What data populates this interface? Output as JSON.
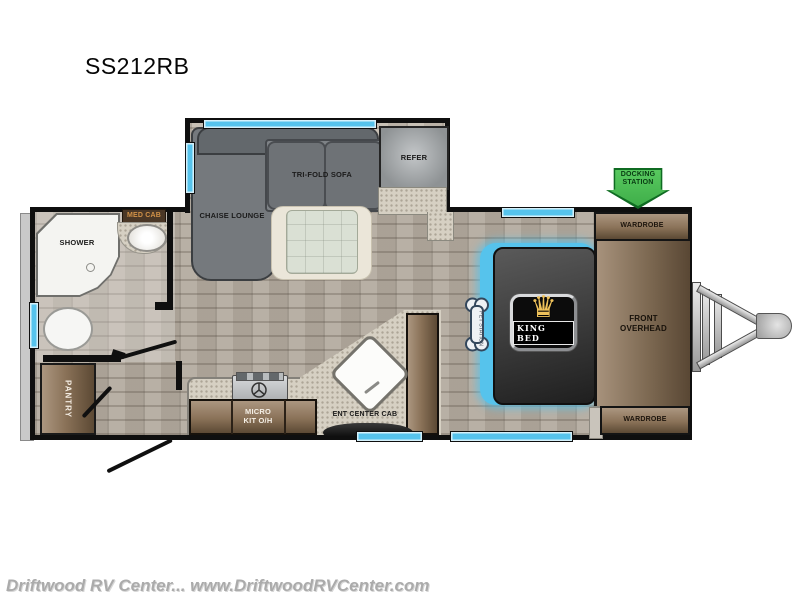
{
  "title": "SS212RB",
  "watermark": "Driftwood RV Center... www.DriftwoodRVCenter.com",
  "icons": {
    "crown": "♛"
  },
  "labels": {
    "shower": "SHOWER",
    "med_cab": "MED CAB",
    "chaise_lounge": "CHAISE LOUNGE",
    "tri_fold_sofa": "TRI-FOLD SOFA",
    "refer": "REFER",
    "docking_station": "DOCKING STATION",
    "wardrobe_front_top": "WARDROBE",
    "front_overhead": "FRONT OVERHEAD",
    "king_bed": "KING BED",
    "wardrobe_front_bottom": "WARDROBE",
    "pantry": "PANTRY",
    "micro_overhead": "MICRO KIT O/H",
    "ent_center_cab": "ENT CENTER CAB",
    "pet_station": "PET STATION"
  },
  "colors": {
    "window_blue": "#56c3ec",
    "docking_green": "#3fae49",
    "docking_green_dark": "#0f6b22",
    "cabinet_brown": "#8a7258",
    "crown_gold": "#eec15a",
    "wall_black": "#0f0f0f"
  }
}
